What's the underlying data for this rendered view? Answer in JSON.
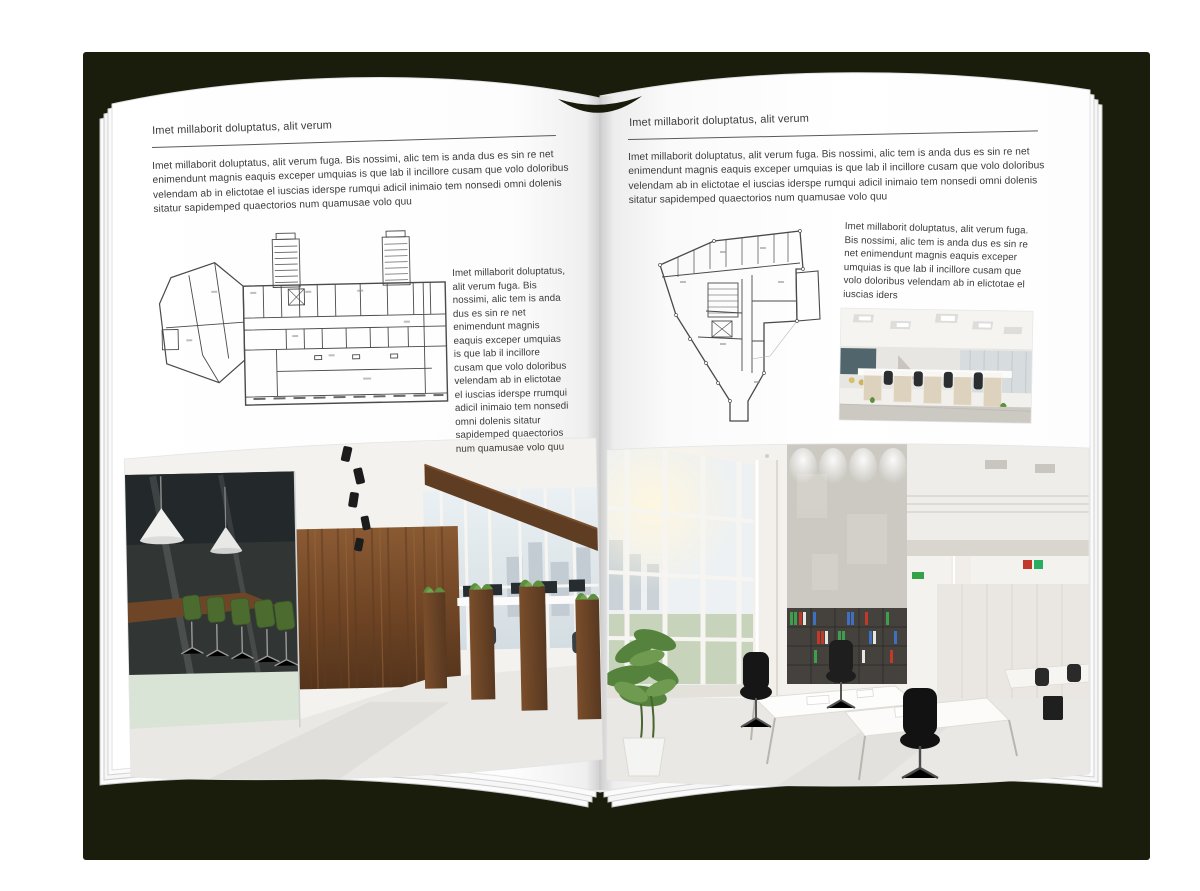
{
  "document": {
    "kind": "open magazine spread mockup",
    "colors": {
      "backdrop_shadow": "#1a1d0b",
      "page": "#ffffff",
      "text": "#3c3c3c",
      "rule": "#5a5a5a"
    }
  },
  "left_page": {
    "header": "Imet millaborit doluptatus, alit verum",
    "intro": "Imet millaborit doluptatus, alit verum fuga. Bis nossimi, alic tem is anda dus es sin re net enimendunt magnis eaquis exceper umquias is que lab il incillore cusam que volo doloribus velendam ab in elictotae el iuscias iderspe rumqui adicil inimaio tem nonsedi omni dolenis sitatur sapidemped quaectorios num quamusae volo quu",
    "side_text": "Imet millaborit doluptatus, alit verum fuga. Bis nossimi, alic tem is anda dus es sin re net enimendunt magnis eaquis exceper umquias is que lab il incillore cusam que volo doloribus velendam ab in elictotae el iuscias iderspe rrumqui adicil inimaio tem nonsedi omni dolenis sitatur sapidemped quaectorios num quamusae volo quu",
    "figures": {
      "floor_plan": "wide multi-wing building floor plan with two stair towers",
      "photo": "dark wood and glass office interior with green chairs"
    }
  },
  "right_page": {
    "header": "Imet millaborit doluptatus, alit verum",
    "intro": "Imet millaborit doluptatus, alit verum fuga. Bis nossimi, alic tem is anda dus es sin re net enimendunt magnis eaquis exceper umquias is que lab il incillore cusam que volo doloribus velendam ab in elictotae el iuscias iderspe rumqui adicil inimaio tem nonsedi omni dolenis sitatur sapidemped quaectorios num quamusae volo quu",
    "side_text": "Imet millaborit doluptatus, alit verum fuga. Bis nossimi, alic tem is anda dus es sin re net enimendunt magnis eaquis exceper umquias is que lab il incillore cusam que volo doloribus velendam ab in elictotae el iuscias iders",
    "figures": {
      "floor_plan": "wedge-shaped building floor plan with central stair core",
      "small_photo": "bright open-plan office with beige cubicle workstations",
      "photo": "white double-height office atrium with tall windows and bookshelves"
    }
  }
}
